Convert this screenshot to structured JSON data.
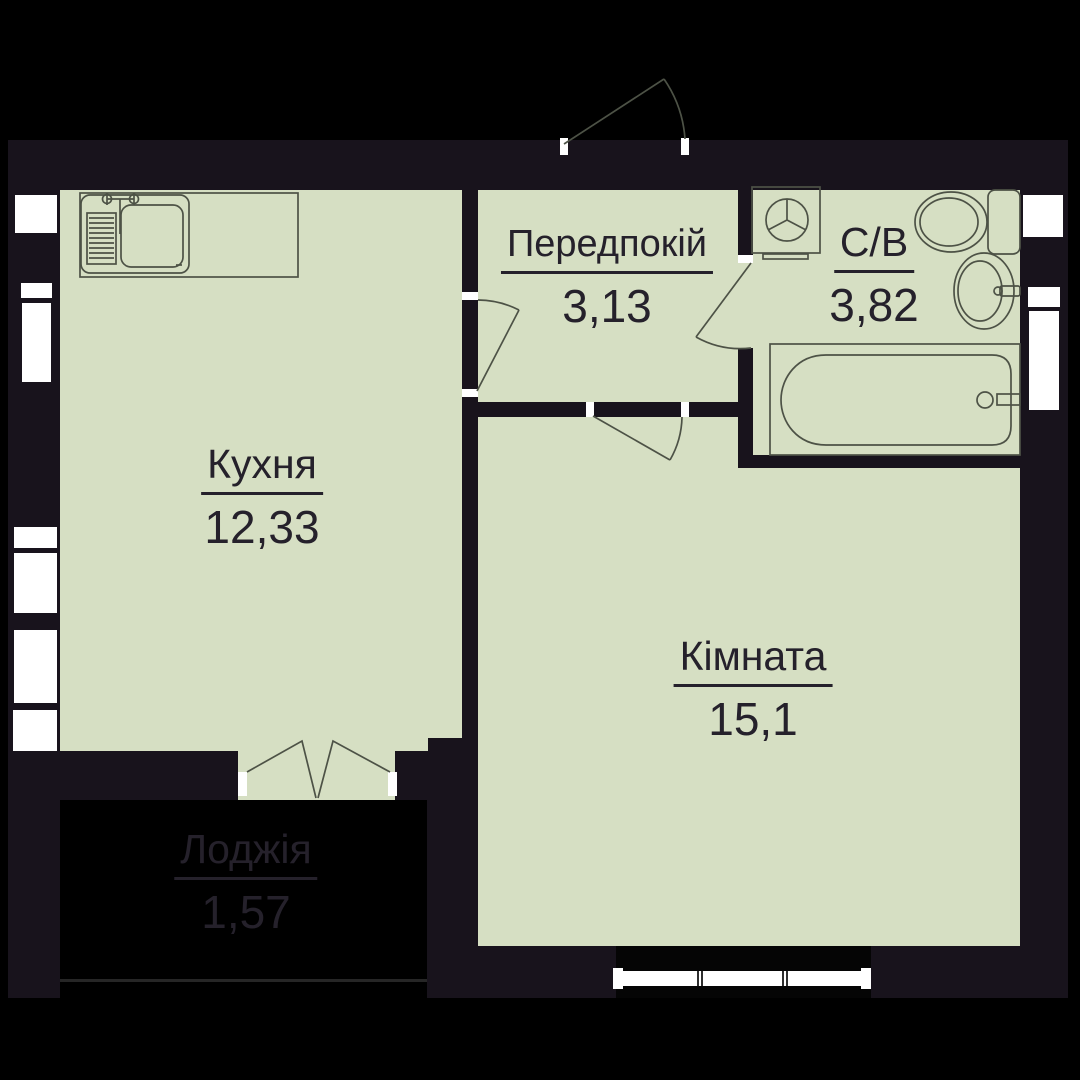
{
  "plan": {
    "title": "Apartment floor plan",
    "language": "uk",
    "colors": {
      "bg": "#000000",
      "wall": "#18131c",
      "room": "#d6dfc3",
      "line": "#4d5246",
      "window": "#ffffff",
      "label": "#25212b"
    },
    "rooms": [
      {
        "id": "kitchen",
        "label": "Кухня",
        "area": "12,33"
      },
      {
        "id": "hallway",
        "label": "Передпокій",
        "area": "3,13"
      },
      {
        "id": "bathroom",
        "label": "С/В",
        "area": "3,82"
      },
      {
        "id": "living-room",
        "label": "Кімната",
        "area": "15,1"
      },
      {
        "id": "loggia",
        "label": "Лоджія",
        "area": "1,57"
      }
    ],
    "fixtures": [
      "kitchen-sink-icon",
      "washing-machine-icon",
      "toilet-icon",
      "washbasin-icon",
      "bathtub-icon",
      "entrance-door-icon",
      "kitchen-door-icon",
      "room-door-icon",
      "bathroom-door-icon",
      "balcony-double-door-icon",
      "window-icon"
    ]
  }
}
